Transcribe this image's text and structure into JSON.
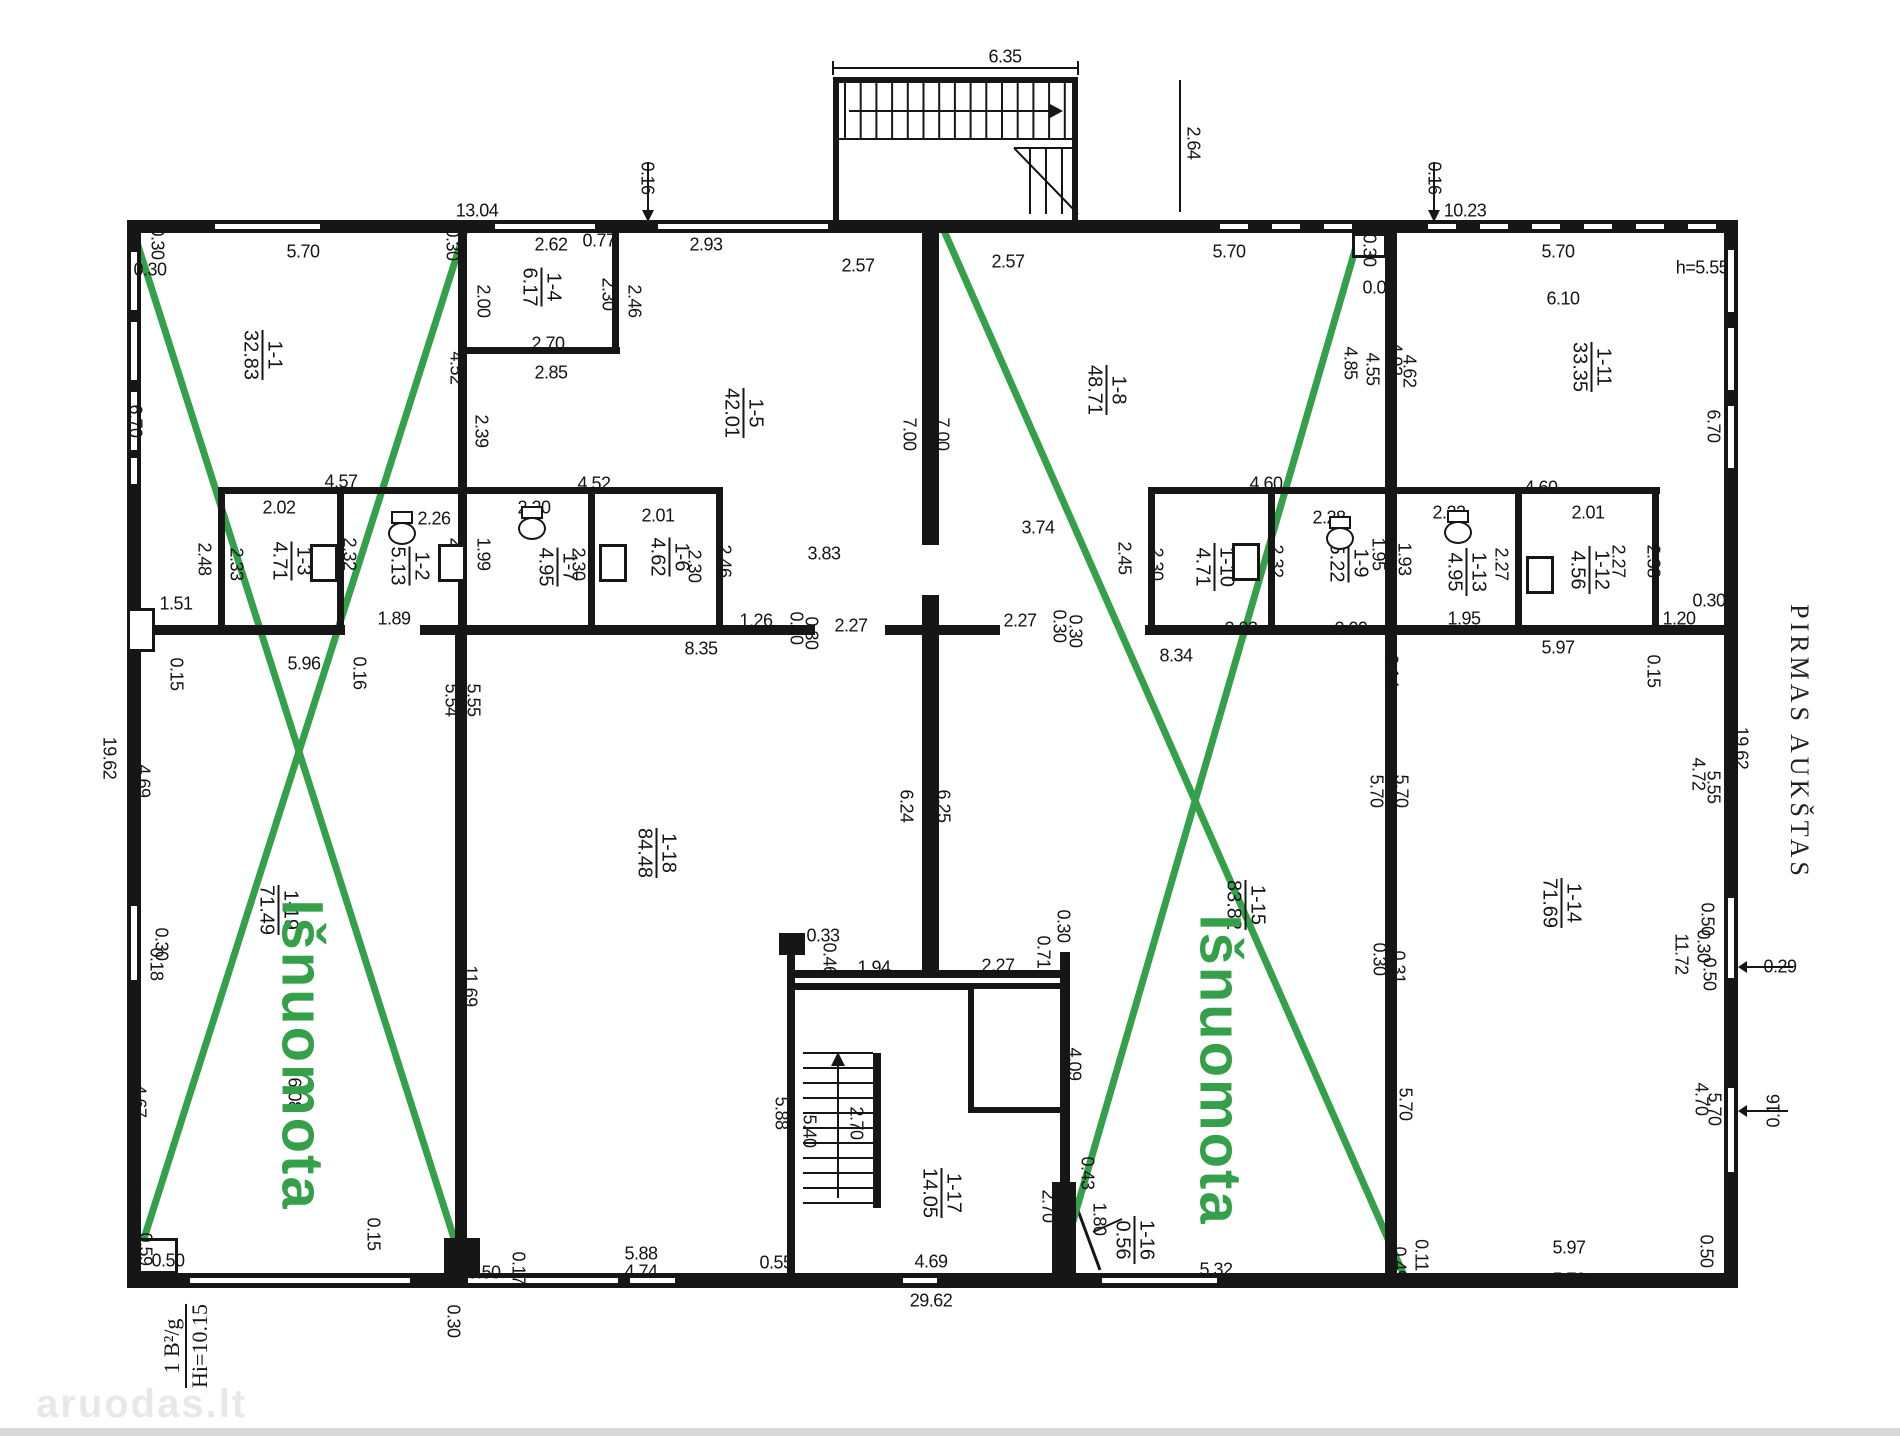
{
  "title": "PIRMAS AUKŠTAS",
  "rented_label": "Išnuomota",
  "watermark": "aruodas.lt",
  "corner_note": {
    "top": "1 B²/g",
    "bottom": "Hi=10.15"
  },
  "colors": {
    "green": "#35a04a",
    "line": "#161616"
  },
  "rooms": [
    {
      "num": "1-1",
      "area": "32.83",
      "x": 262,
      "y": 355
    },
    {
      "num": "1-4",
      "area": "6.17",
      "x": 541,
      "y": 287
    },
    {
      "num": "1-5",
      "area": "42.01",
      "x": 743,
      "y": 413
    },
    {
      "num": "1-8",
      "area": "48.71",
      "x": 1106,
      "y": 390
    },
    {
      "num": "1-11",
      "area": "33.35",
      "x": 1591,
      "y": 367
    },
    {
      "num": "1-3",
      "area": "4.71",
      "x": 291,
      "y": 561
    },
    {
      "num": "1-2",
      "area": "5.13",
      "x": 409,
      "y": 566
    },
    {
      "num": "1-7",
      "area": "4.95",
      "x": 557,
      "y": 567
    },
    {
      "num": "1-6",
      "area": "4.62",
      "x": 669,
      "y": 557
    },
    {
      "num": "1-10",
      "area": "4.71",
      "x": 1214,
      "y": 567
    },
    {
      "num": "1-9",
      "area": "5.22",
      "x": 1348,
      "y": 563
    },
    {
      "num": "1-13",
      "area": "4.95",
      "x": 1466,
      "y": 572
    },
    {
      "num": "1-12",
      "area": "4.56",
      "x": 1589,
      "y": 570
    },
    {
      "num": "1-19",
      "area": "71.49",
      "x": 278,
      "y": 910
    },
    {
      "num": "1-18",
      "area": "84.48",
      "x": 656,
      "y": 853
    },
    {
      "num": "1-15",
      "area": "83.82",
      "x": 1245,
      "y": 905
    },
    {
      "num": "1-14",
      "area": "71.69",
      "x": 1561,
      "y": 903
    },
    {
      "num": "1-17",
      "area": "14.05",
      "x": 941,
      "y": 1193
    },
    {
      "num": "1-16",
      "area": "0.56",
      "x": 1134,
      "y": 1240
    }
  ],
  "dims": [
    {
      "t": "6.35",
      "x": 1005,
      "y": 57
    },
    {
      "t": "2.64",
      "x": 1193,
      "y": 143,
      "r": 1
    },
    {
      "t": "0.16",
      "x": 647,
      "y": 178,
      "r": 1
    },
    {
      "t": "13.04",
      "x": 477,
      "y": 211
    },
    {
      "t": "0.16",
      "x": 1434,
      "y": 178,
      "r": 1
    },
    {
      "t": "10.23",
      "x": 1465,
      "y": 211
    },
    {
      "t": "h=5.55",
      "x": 1702,
      "y": 268
    },
    {
      "t": "0.30",
      "x": 157,
      "y": 243,
      "r": 1
    },
    {
      "t": "0.30",
      "x": 150,
      "y": 270
    },
    {
      "t": "5.70",
      "x": 303,
      "y": 252
    },
    {
      "t": "0.30",
      "x": 452,
      "y": 244,
      "r": 1
    },
    {
      "t": "2.62",
      "x": 551,
      "y": 245
    },
    {
      "t": "0.77",
      "x": 599,
      "y": 241
    },
    {
      "t": "2.93",
      "x": 706,
      "y": 245
    },
    {
      "t": "2.57",
      "x": 858,
      "y": 266
    },
    {
      "t": "2.57",
      "x": 1008,
      "y": 262
    },
    {
      "t": "5.70",
      "x": 1229,
      "y": 252
    },
    {
      "t": "0.30",
      "x": 1369,
      "y": 250,
      "r": 1
    },
    {
      "t": "0.07",
      "x": 1379,
      "y": 288
    },
    {
      "t": "5.70",
      "x": 1558,
      "y": 252
    },
    {
      "t": "6.10",
      "x": 1563,
      "y": 299
    },
    {
      "t": "2.00",
      "x": 483,
      "y": 301,
      "r": 1
    },
    {
      "t": "2.30",
      "x": 608,
      "y": 294,
      "r": 1
    },
    {
      "t": "2.46",
      "x": 634,
      "y": 301,
      "r": 1
    },
    {
      "t": "2.70",
      "x": 548,
      "y": 344
    },
    {
      "t": "2.85",
      "x": 551,
      "y": 373
    },
    {
      "t": "4.52",
      "x": 456,
      "y": 368,
      "r": 1
    },
    {
      "t": "2.39",
      "x": 481,
      "y": 431,
      "r": 1
    },
    {
      "t": "7.00",
      "x": 909,
      "y": 434,
      "r": 1
    },
    {
      "t": "7.00",
      "x": 942,
      "y": 434,
      "r": 1
    },
    {
      "t": "4.85",
      "x": 1350,
      "y": 363,
      "r": 1
    },
    {
      "t": "4.55",
      "x": 1372,
      "y": 369,
      "r": 1
    },
    {
      "t": "4.92",
      "x": 1395,
      "y": 359,
      "r": 1
    },
    {
      "t": "4.62",
      "x": 1409,
      "y": 371,
      "r": 1
    },
    {
      "t": "6.70",
      "x": 135,
      "y": 421,
      "r": 1
    },
    {
      "t": "6.70",
      "x": 1713,
      "y": 426,
      "r": 1
    },
    {
      "t": "3.83",
      "x": 824,
      "y": 554
    },
    {
      "t": "3.74",
      "x": 1038,
      "y": 528
    },
    {
      "t": "4.57",
      "x": 341,
      "y": 482
    },
    {
      "t": "4.52",
      "x": 594,
      "y": 484
    },
    {
      "t": "4.60",
      "x": 1266,
      "y": 484
    },
    {
      "t": "4.60",
      "x": 1541,
      "y": 488
    },
    {
      "t": "2.02",
      "x": 279,
      "y": 508
    },
    {
      "t": "2.26",
      "x": 434,
      "y": 519
    },
    {
      "t": "2.20",
      "x": 534,
      "y": 508
    },
    {
      "t": "2.01",
      "x": 658,
      "y": 516
    },
    {
      "t": "2.28",
      "x": 1329,
      "y": 518
    },
    {
      "t": "2.22",
      "x": 1449,
      "y": 513
    },
    {
      "t": "2.01",
      "x": 1588,
      "y": 513
    },
    {
      "t": "2.48",
      "x": 204,
      "y": 559,
      "r": 1
    },
    {
      "t": "2.33",
      "x": 236,
      "y": 564,
      "r": 1
    },
    {
      "t": "2.32",
      "x": 349,
      "y": 554,
      "r": 1
    },
    {
      "t": "2.02",
      "x": 456,
      "y": 554,
      "r": 1
    },
    {
      "t": "1.99",
      "x": 483,
      "y": 554,
      "r": 1
    },
    {
      "t": "2.30",
      "x": 578,
      "y": 564,
      "r": 1
    },
    {
      "t": "2.30",
      "x": 694,
      "y": 566,
      "r": 1
    },
    {
      "t": "2.46",
      "x": 724,
      "y": 561,
      "r": 1
    },
    {
      "t": "2.45",
      "x": 1124,
      "y": 558,
      "r": 1
    },
    {
      "t": "2.30",
      "x": 1156,
      "y": 564,
      "r": 1
    },
    {
      "t": "2.32",
      "x": 1276,
      "y": 561,
      "r": 1
    },
    {
      "t": "1.95",
      "x": 1378,
      "y": 554,
      "r": 1
    },
    {
      "t": "1.93",
      "x": 1404,
      "y": 559,
      "r": 1
    },
    {
      "t": "2.27",
      "x": 1501,
      "y": 564,
      "r": 1
    },
    {
      "t": "2.27",
      "x": 1618,
      "y": 561,
      "r": 1
    },
    {
      "t": "2.38",
      "x": 1653,
      "y": 561,
      "r": 1
    },
    {
      "t": "1.51",
      "x": 176,
      "y": 604
    },
    {
      "t": "1.89",
      "x": 394,
      "y": 619
    },
    {
      "t": "1.26",
      "x": 756,
      "y": 621
    },
    {
      "t": "0.30",
      "x": 796,
      "y": 628,
      "r": 1
    },
    {
      "t": "0.30",
      "x": 811,
      "y": 633,
      "r": 1
    },
    {
      "t": "2.27",
      "x": 851,
      "y": 626
    },
    {
      "t": "2.27",
      "x": 1020,
      "y": 621
    },
    {
      "t": "0.30",
      "x": 1059,
      "y": 626,
      "r": 1
    },
    {
      "t": "0.30",
      "x": 1075,
      "y": 631,
      "r": 1
    },
    {
      "t": "2.03",
      "x": 1241,
      "y": 629
    },
    {
      "t": "2.09",
      "x": 1351,
      "y": 629
    },
    {
      "t": "1.95",
      "x": 1464,
      "y": 619
    },
    {
      "t": "1.20",
      "x": 1679,
      "y": 619
    },
    {
      "t": "0.30",
      "x": 1709,
      "y": 601
    },
    {
      "t": "5.96",
      "x": 304,
      "y": 664
    },
    {
      "t": "0.15",
      "x": 176,
      "y": 674,
      "r": 1
    },
    {
      "t": "0.16",
      "x": 359,
      "y": 673,
      "r": 1
    },
    {
      "t": "8.35",
      "x": 701,
      "y": 649
    },
    {
      "t": "8.34",
      "x": 1176,
      "y": 656
    },
    {
      "t": "0.14",
      "x": 1391,
      "y": 671,
      "r": 1
    },
    {
      "t": "5.97",
      "x": 1558,
      "y": 648
    },
    {
      "t": "0.15",
      "x": 1653,
      "y": 671,
      "r": 1
    },
    {
      "t": "19.62",
      "x": 109,
      "y": 758,
      "r": 1
    },
    {
      "t": "4.69",
      "x": 143,
      "y": 781,
      "r": 1
    },
    {
      "t": "0.30",
      "x": 161,
      "y": 944,
      "r": 1
    },
    {
      "t": "0.18",
      "x": 156,
      "y": 964,
      "r": 1
    },
    {
      "t": "4.67",
      "x": 139,
      "y": 1101,
      "r": 1
    },
    {
      "t": "6.08",
      "x": 294,
      "y": 1094,
      "r": 1
    },
    {
      "t": "19.62",
      "x": 1741,
      "y": 748,
      "r": 1
    },
    {
      "t": "4.72",
      "x": 1698,
      "y": 774,
      "r": 1
    },
    {
      "t": "5.55",
      "x": 1713,
      "y": 787,
      "r": 1
    },
    {
      "t": "0.50",
      "x": 1707,
      "y": 919,
      "r": 1
    },
    {
      "t": "0.30",
      "x": 1703,
      "y": 946,
      "r": 1
    },
    {
      "t": "0.50",
      "x": 1709,
      "y": 974,
      "r": 1
    },
    {
      "t": "11.72",
      "x": 1681,
      "y": 954,
      "r": 1
    },
    {
      "t": "0.29",
      "x": 1780,
      "y": 967
    },
    {
      "t": "4.70",
      "x": 1701,
      "y": 1099,
      "r": 1
    },
    {
      "t": "5.70",
      "x": 1714,
      "y": 1109,
      "r": 1
    },
    {
      "t": "0.16",
      "x": 1774,
      "y": 1111,
      "r": -1
    },
    {
      "t": "5.54",
      "x": 451,
      "y": 700,
      "r": 1
    },
    {
      "t": "5.55",
      "x": 473,
      "y": 700,
      "r": 1
    },
    {
      "t": "11.69",
      "x": 470,
      "y": 986,
      "r": 1
    },
    {
      "t": "5.70",
      "x": 1376,
      "y": 791,
      "r": 1
    },
    {
      "t": "5.70",
      "x": 1401,
      "y": 791,
      "r": 1
    },
    {
      "t": "0.30",
      "x": 1379,
      "y": 959,
      "r": 1
    },
    {
      "t": "0.31",
      "x": 1398,
      "y": 967,
      "r": 1
    },
    {
      "t": "5.70",
      "x": 1405,
      "y": 1104,
      "r": 1
    },
    {
      "t": "6.24",
      "x": 906,
      "y": 806,
      "r": 1
    },
    {
      "t": "6.25",
      "x": 943,
      "y": 806,
      "r": 1
    },
    {
      "t": "0.33",
      "x": 823,
      "y": 936
    },
    {
      "t": "0.46",
      "x": 829,
      "y": 959,
      "r": 1
    },
    {
      "t": "1.94",
      "x": 874,
      "y": 968
    },
    {
      "t": "2.27",
      "x": 998,
      "y": 966
    },
    {
      "t": "0.71",
      "x": 1043,
      "y": 952,
      "r": 1
    },
    {
      "t": "0.30",
      "x": 1063,
      "y": 926,
      "r": 1
    },
    {
      "t": "4.09",
      "x": 1074,
      "y": 1064,
      "r": 1
    },
    {
      "t": "5.88",
      "x": 781,
      "y": 1113,
      "r": 1
    },
    {
      "t": "5.40",
      "x": 809,
      "y": 1131,
      "r": 1
    },
    {
      "t": "2.70",
      "x": 856,
      "y": 1123,
      "r": 1
    },
    {
      "t": "2.70",
      "x": 1048,
      "y": 1206,
      "r": 1
    },
    {
      "t": "1.80",
      "x": 1099,
      "y": 1219,
      "r": 1
    },
    {
      "t": "0.43",
      "x": 1087,
      "y": 1173,
      "r": 1
    },
    {
      "t": "0.15",
      "x": 373,
      "y": 1234,
      "r": 1
    },
    {
      "t": "0.30",
      "x": 453,
      "y": 1321,
      "r": 1
    },
    {
      "t": "0.50",
      "x": 484,
      "y": 1273
    },
    {
      "t": "0.17",
      "x": 518,
      "y": 1268,
      "r": 1
    },
    {
      "t": "5.88",
      "x": 641,
      "y": 1254
    },
    {
      "t": "4.74",
      "x": 641,
      "y": 1272
    },
    {
      "t": "0.55",
      "x": 776,
      "y": 1263
    },
    {
      "t": "4.69",
      "x": 931,
      "y": 1262
    },
    {
      "t": "29.62",
      "x": 931,
      "y": 1301
    },
    {
      "t": "5.32",
      "x": 1216,
      "y": 1270
    },
    {
      "t": "0.49",
      "x": 1399,
      "y": 1263,
      "r": 1
    },
    {
      "t": "0.11",
      "x": 1421,
      "y": 1255,
      "r": 1
    },
    {
      "t": "5.97",
      "x": 1569,
      "y": 1248
    },
    {
      "t": "5.70",
      "x": 1569,
      "y": 1280
    },
    {
      "t": "0.50",
      "x": 1706,
      "y": 1251,
      "r": 1
    },
    {
      "t": "0.59",
      "x": 145,
      "y": 1249,
      "r": 1
    },
    {
      "t": "0.50",
      "x": 168,
      "y": 1261
    }
  ],
  "fixtures": {
    "toilets": [
      {
        "x": 402,
        "y": 528
      },
      {
        "x": 532,
        "y": 523
      },
      {
        "x": 1340,
        "y": 533
      },
      {
        "x": 1458,
        "y": 527
      }
    ],
    "doors": [
      {
        "x": 324,
        "y": 563
      },
      {
        "x": 452,
        "y": 563
      },
      {
        "x": 613,
        "y": 563
      },
      {
        "x": 1246,
        "y": 562
      },
      {
        "x": 1540,
        "y": 575
      }
    ]
  },
  "green": {
    "lines": [
      [
        133,
        230,
        465,
        1273
      ],
      [
        465,
        230,
        133,
        1273
      ],
      [
        945,
        233,
        1403,
        1273
      ],
      [
        1360,
        233,
        1058,
        1273
      ]
    ],
    "labels": [
      {
        "x": 302,
        "y": 1055
      },
      {
        "x": 1220,
        "y": 1070
      }
    ]
  }
}
